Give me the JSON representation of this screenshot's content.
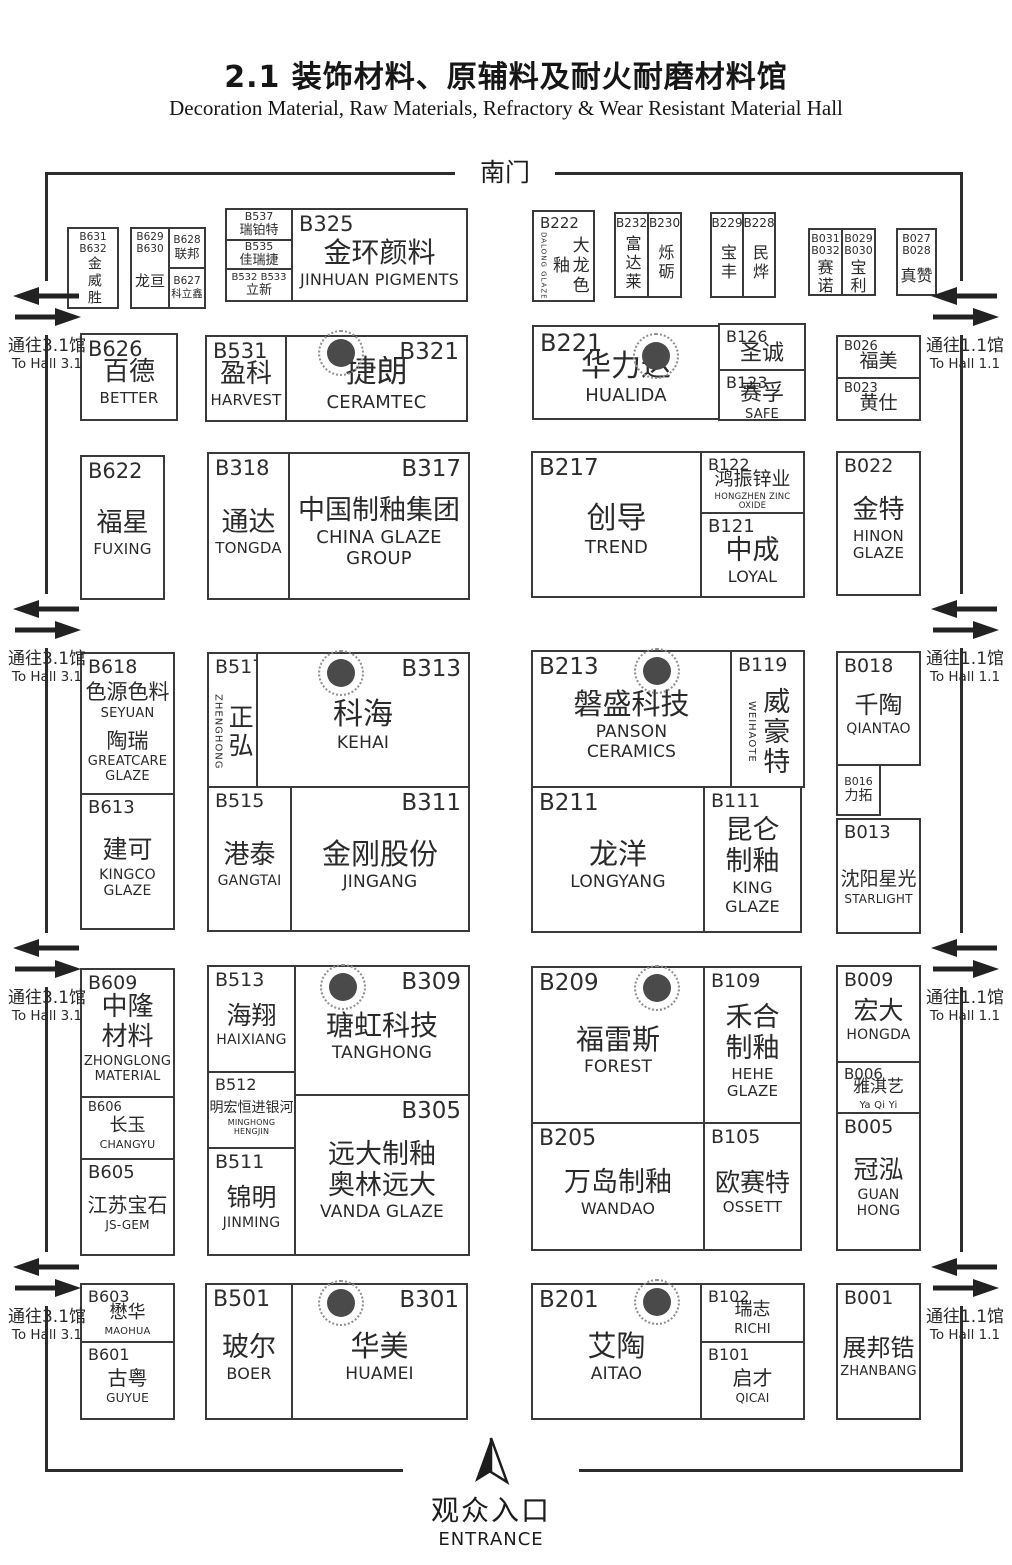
{
  "header": {
    "title": "2.1 装饰材料、原辅料及耐火耐磨材料馆",
    "subtitle": "Decoration Material, Raw Materials, Refractory & Wear Resistant Material Hall"
  },
  "labels": {
    "south_gate": "南门",
    "entrance_cn": "观众入口",
    "entrance_en": "ENTRANCE",
    "to_hall_31_cn": "通往3.1馆",
    "to_hall_31_en": "To Hall 3.1",
    "to_hall_11_cn": "通往1.1馆",
    "to_hall_11_en": "To Hall 1.1"
  },
  "icons": {
    "pillar": "column-pillar-marker",
    "gate": "two-way-arrow",
    "entrance": "north-arrow"
  },
  "colors": {
    "line": "#2c2c2c",
    "pillar_fill": "#4a4a4a"
  },
  "booths": {
    "b631": {
      "code": "B631",
      "code2": "B632",
      "cn": "金威胜"
    },
    "b629": {
      "code": "B629",
      "code2": "B630",
      "cn": "龙亘"
    },
    "b628": {
      "code": "B628",
      "cn": "联邦"
    },
    "b627": {
      "code": "B627",
      "cn": "科立鑫"
    },
    "b537": {
      "code": "B537",
      "cn": "瑞铂特"
    },
    "b535": {
      "code": "B535",
      "cn": "佳瑞捷"
    },
    "b532": {
      "code": "B532 B533",
      "cn": "立新"
    },
    "b325": {
      "code": "B325",
      "cn": "金环颜料",
      "en": "JINHUAN PIGMENTS"
    },
    "b222": {
      "code": "B222",
      "cn": "大龙色釉",
      "en": "DALONG GLAZE"
    },
    "b232": {
      "code": "B232",
      "cn": "富达莱"
    },
    "b230": {
      "code": "B230",
      "cn": "烁砺"
    },
    "b229": {
      "code": "B229",
      "cn": "宝丰"
    },
    "b228": {
      "code": "B228",
      "cn": "民烨"
    },
    "b031": {
      "code": "B031",
      "code2": "B032",
      "cn": "赛诺"
    },
    "b029": {
      "code": "B029",
      "code2": "B030",
      "cn": "宝利"
    },
    "b027": {
      "code": "B027",
      "code2": "B028",
      "cn": "真赞"
    },
    "b626": {
      "code": "B626",
      "cn": "百德",
      "en": "BETTER"
    },
    "b531": {
      "code": "B531",
      "cn": "盈科",
      "en": "HARVEST"
    },
    "b321": {
      "code": "B321",
      "cn": "捷朗",
      "en": "CERAMTEC"
    },
    "b221": {
      "code": "B221",
      "cn": "华力达",
      "en": "HUALIDA"
    },
    "b126": {
      "code": "B126",
      "cn": "圣诚"
    },
    "b123": {
      "code": "B123",
      "cn": "赛孚",
      "en": "SAFE"
    },
    "b026": {
      "code": "B026",
      "cn": "福美"
    },
    "b023": {
      "code": "B023",
      "cn": "黄仕"
    },
    "b622": {
      "code": "B622",
      "cn": "福星",
      "en": "FUXING"
    },
    "b318": {
      "code": "B318",
      "cn": "通达",
      "en": "TONGDA"
    },
    "b317": {
      "code": "B317",
      "cn": "中国制釉集团",
      "en": "CHINA GLAZE\nGROUP"
    },
    "b217": {
      "code": "B217",
      "cn": "创导",
      "en": "TREND"
    },
    "b122": {
      "code": "B122",
      "cn": "鸿振锌业",
      "en": "HONGZHEN ZINC OXIDE"
    },
    "b121": {
      "code": "B121",
      "cn": "中成",
      "en": "LOYAL"
    },
    "b022": {
      "code": "B022",
      "cn": "金特",
      "en": "HINON\nGLAZE"
    },
    "b618": {
      "code": "B618",
      "cn": "色源色料",
      "en": "SEYUAN",
      "cn2": "陶瑞",
      "en2": "GREATCARE\nGLAZE"
    },
    "b517": {
      "code": "B517",
      "cn": "正弘",
      "en": "ZHENGHONG"
    },
    "b313": {
      "code": "B313",
      "cn": "科海",
      "en": "KEHAI"
    },
    "b213": {
      "code": "B213",
      "cn": "磐盛科技",
      "en": "PANSON\nCERAMICS"
    },
    "b119": {
      "code": "B119",
      "cn": "威豪特",
      "en": "WEIHAOTE"
    },
    "b018": {
      "code": "B018",
      "cn": "千陶",
      "en": "QIANTAO"
    },
    "b016": {
      "code": "B016",
      "cn": "力拓"
    },
    "b613": {
      "code": "B613",
      "cn": "建可",
      "en": "KINGCO\nGLAZE"
    },
    "b515": {
      "code": "B515",
      "cn": "港泰",
      "en": "GANGTAI"
    },
    "b311": {
      "code": "B311",
      "cn": "金刚股份",
      "en": "JINGANG"
    },
    "b211": {
      "code": "B211",
      "cn": "龙洋",
      "en": "LONGYANG"
    },
    "b111": {
      "code": "B111",
      "cn": "昆仑\n制釉",
      "en": "KING\nGLAZE"
    },
    "b013": {
      "code": "B013",
      "cn": "沈阳星光",
      "en": "STARLIGHT"
    },
    "b609": {
      "code": "B609",
      "cn": "中隆\n材料",
      "en": "ZHONGLONG\nMATERIAL"
    },
    "b513": {
      "code": "B513",
      "cn": "海翔",
      "en": "HAIXIANG"
    },
    "b309": {
      "code": "B309",
      "cn": "瑭虹科技",
      "en": "TANGHONG"
    },
    "b209": {
      "code": "B209",
      "cn": "福雷斯",
      "en": "FOREST"
    },
    "b109": {
      "code": "B109",
      "cn": "禾合\n制釉",
      "en": "HEHE\nGLAZE"
    },
    "b009": {
      "code": "B009",
      "cn": "宏大",
      "en": "HONGDA"
    },
    "b006": {
      "code": "B006",
      "cn": "雅淇艺",
      "en": "Ya Qi Yi"
    },
    "b606": {
      "code": "B606",
      "cn": "长玉",
      "en": "CHANGYU"
    },
    "b605": {
      "code": "B605",
      "cn": "江苏宝石",
      "en": "JS-GEM"
    },
    "b512": {
      "code": "B512",
      "cn": "明宏恒进银河",
      "en": "MINGHONG HENGJIN"
    },
    "b511": {
      "code": "B511",
      "cn": "锦明",
      "en": "JINMING"
    },
    "b305": {
      "code": "B305",
      "cn": "远大制釉",
      "cn2": "奥林远大",
      "en": "VANDA GLAZE"
    },
    "b205": {
      "code": "B205",
      "cn": "万岛制釉",
      "en": "WANDAO"
    },
    "b105": {
      "code": "B105",
      "cn": "欧赛特",
      "en": "OSSETT"
    },
    "b005": {
      "code": "B005",
      "cn": "冠泓",
      "en": "GUAN\nHONG"
    },
    "b603": {
      "code": "B603",
      "cn": "懋华",
      "en": "MAOHUA"
    },
    "b601": {
      "code": "B601",
      "cn": "古粤",
      "en": "GUYUE"
    },
    "b501": {
      "code": "B501",
      "cn": "玻尔",
      "en": "BOER"
    },
    "b301": {
      "code": "B301",
      "cn": "华美",
      "en": "HUAMEI"
    },
    "b201": {
      "code": "B201",
      "cn": "艾陶",
      "en": "AITAO"
    },
    "b102": {
      "code": "B102",
      "cn": "瑞志",
      "en": "RICHI"
    },
    "b101": {
      "code": "B101",
      "cn": "启才",
      "en": "QICAI"
    },
    "b001": {
      "code": "B001",
      "cn": "展邦锆",
      "en": "ZHANBANG"
    }
  }
}
